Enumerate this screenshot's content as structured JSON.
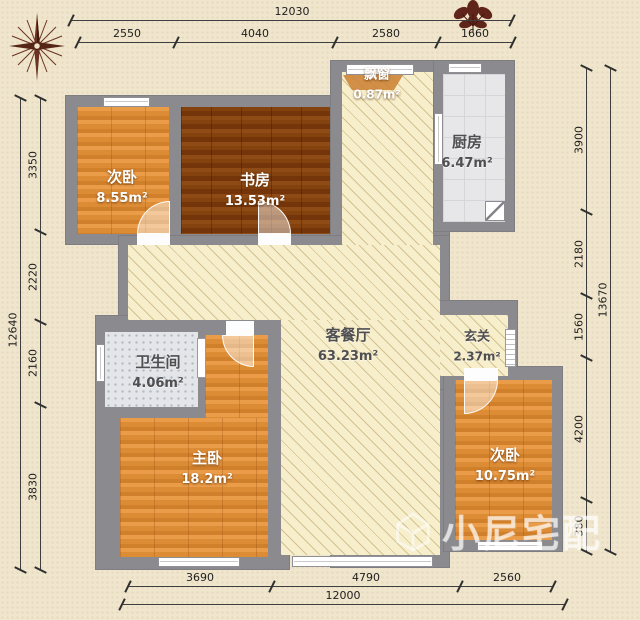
{
  "title": "apartment-floor-plan",
  "rooms": [
    {
      "name": "次卧",
      "area": "8.55m²"
    },
    {
      "name": "书房",
      "area": "13.53m²"
    },
    {
      "name": "飘窗",
      "area": "0.87m²"
    },
    {
      "name": "厨房",
      "area": "6.47m²"
    },
    {
      "name": "客餐厅",
      "area": "63.23m²"
    },
    {
      "name": "玄关",
      "area": "2.37m²"
    },
    {
      "name": "卫生间",
      "area": "4.06m²"
    },
    {
      "name": "主卧",
      "area": "18.2m²"
    },
    {
      "name": "次卧",
      "area": "10.75m²"
    }
  ],
  "dimensions": {
    "top": {
      "total": "12030",
      "segments": [
        "2550",
        "4040",
        "2580",
        "1660"
      ]
    },
    "bottom": {
      "total": "12000",
      "segments": [
        "3690",
        "4790",
        "2560"
      ]
    },
    "left": {
      "total": "12640",
      "segments": [
        "3350",
        "2220",
        "2160",
        "3830"
      ]
    },
    "right": {
      "total": "13670",
      "segments": [
        "3900",
        "2180",
        "1560",
        "4200",
        "380"
      ]
    }
  },
  "watermark": {
    "text": "小尼宅配"
  },
  "icons": {
    "compass": "compass-rose",
    "plant": "decorative-plant",
    "logo": "house-cube-logo"
  },
  "colors": {
    "wall": "#8b8b8f",
    "wood_light": "#e0913e",
    "wood_dark": "#7b3a10",
    "hatch_floor": "#f7eecb",
    "tile": "#e7e7e9",
    "background": "#f0e6cd"
  }
}
